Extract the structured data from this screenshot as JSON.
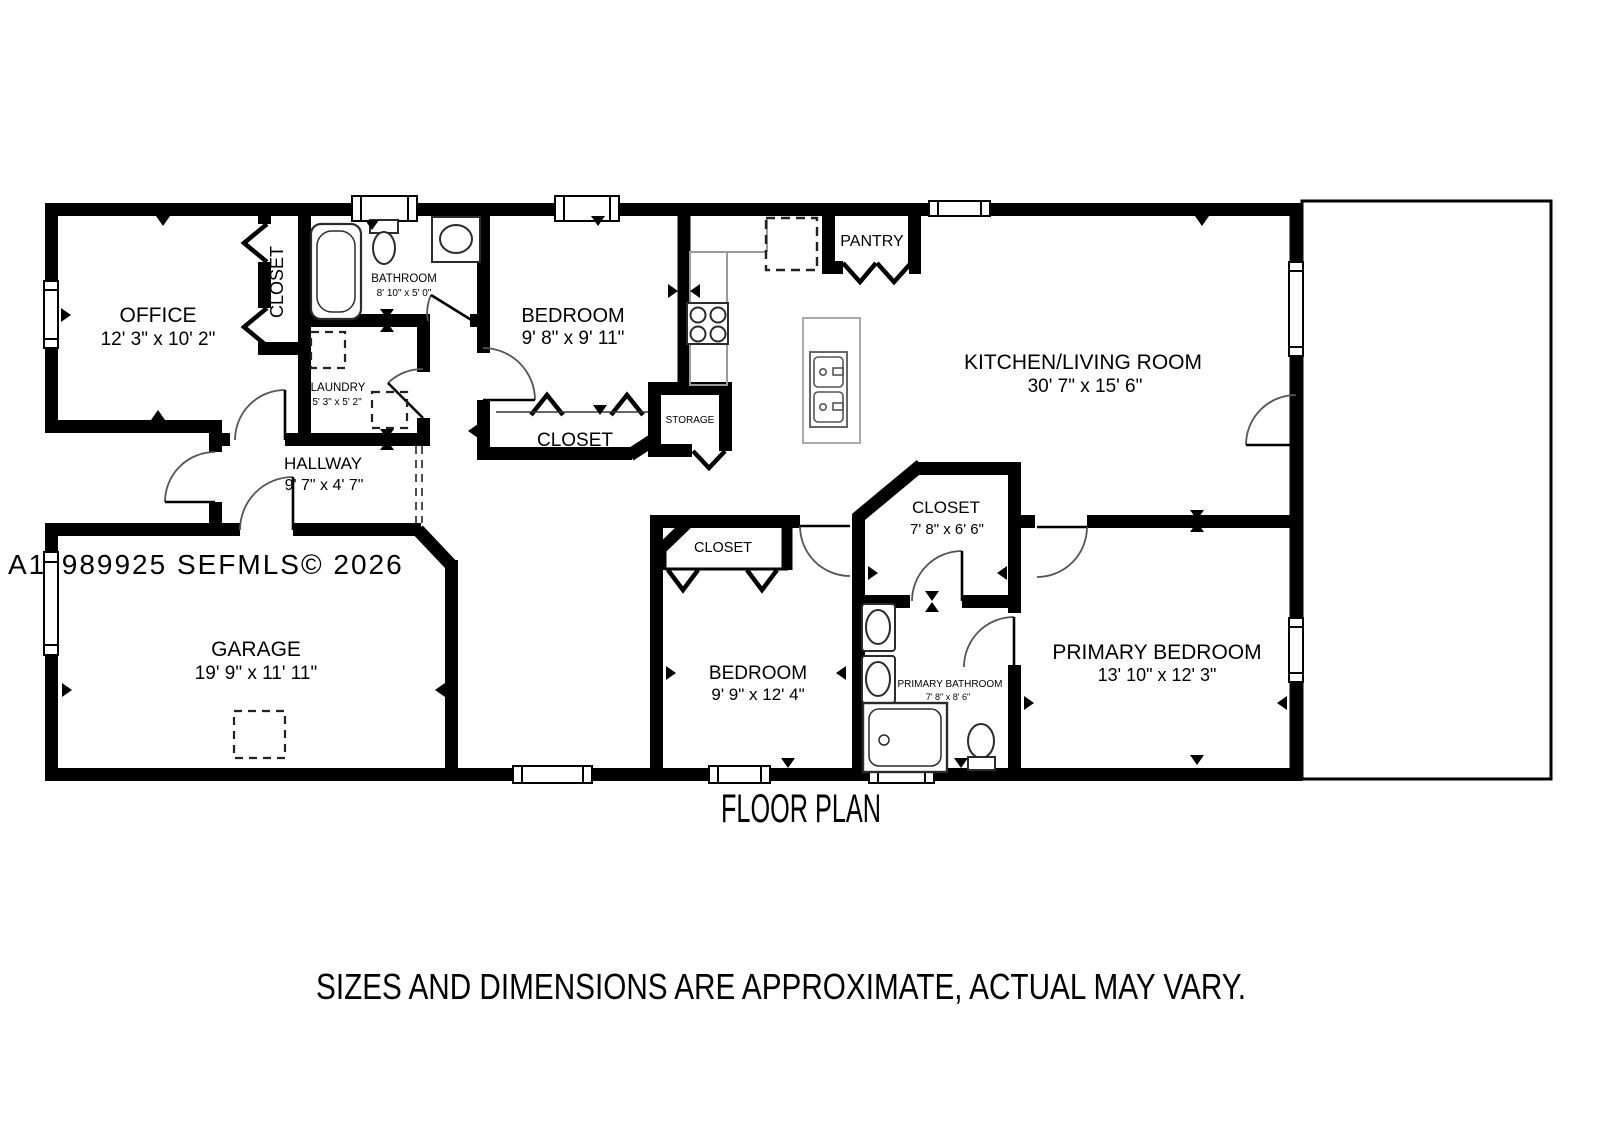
{
  "page": {
    "title": "FLOOR PLAN",
    "disclaimer": "SIZES AND DIMENSIONS ARE APPROXIMATE, ACTUAL MAY VARY.",
    "watermark": "A11989925  SEFMLS© 2026"
  },
  "rooms": {
    "office": {
      "label": "OFFICE",
      "dims": "12' 3\" x 10' 2\""
    },
    "office_closet": {
      "label": "CLOSET"
    },
    "bathroom": {
      "label": "BATHROOM",
      "dims": "8' 10\" x 5' 0\""
    },
    "laundry": {
      "label": "LAUNDRY",
      "dims": "5' 3\" x 5' 2\""
    },
    "bedroom_top": {
      "label": "BEDROOM",
      "dims": "9' 8\" x 9' 11\""
    },
    "bedroom_top_closet": {
      "label": "CLOSET"
    },
    "storage": {
      "label": "STORAGE"
    },
    "pantry": {
      "label": "PANTRY"
    },
    "kitchen_living": {
      "label": "KITCHEN/LIVING ROOM",
      "dims": "30' 7\" x 15' 6\""
    },
    "hallway": {
      "label": "HALLWAY",
      "dims": "9' 7\" x 4' 7\""
    },
    "garage": {
      "label": "GARAGE",
      "dims": "19' 9\" x 11' 11\""
    },
    "primary_closet": {
      "label": "CLOSET",
      "dims": "7' 8\" x 6' 6\""
    },
    "bedroom_bottom": {
      "label": "BEDROOM",
      "dims": "9' 9\" x 12' 4\""
    },
    "bedroom_bottom_closet": {
      "label": "CLOSET"
    },
    "primary_bathroom": {
      "label": "PRIMARY BATHROOM",
      "dims": "7' 8\" x 8' 6\""
    },
    "primary_bedroom": {
      "label": "PRIMARY BEDROOM",
      "dims": "13' 10\" x 12' 3\""
    }
  },
  "colors": {
    "walls": "#000000",
    "watermark": "#ababab",
    "disclaimer": "#4d4d4d",
    "counter": "#9a9a9a",
    "fixture": "#2b2b2b"
  }
}
